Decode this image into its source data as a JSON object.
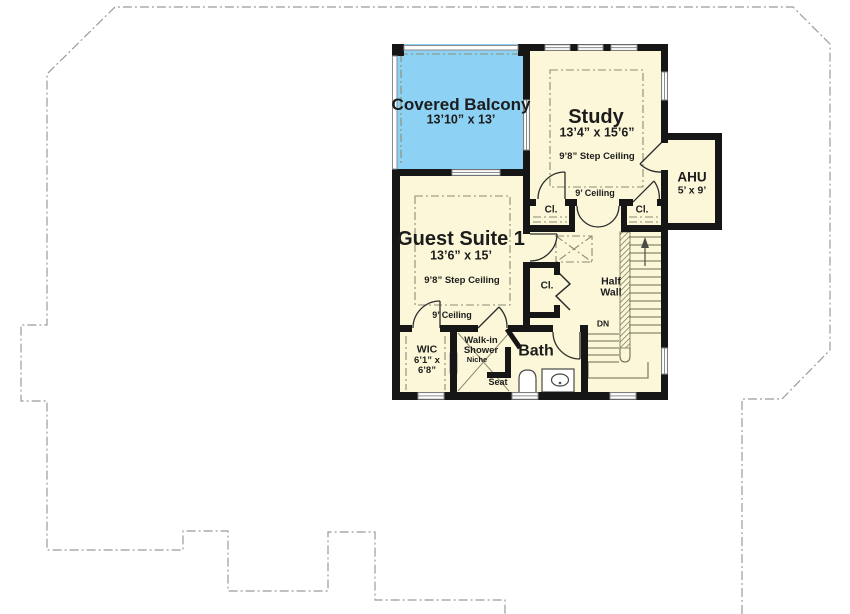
{
  "rooms": {
    "covered_balcony": {
      "name": "Covered Balcony",
      "dims": "13’10” x 13’"
    },
    "study": {
      "name": "Study",
      "dims": "13’4” x 15’6”",
      "step_ceiling": "9’8” Step Ceiling",
      "ceiling": "9’ Ceiling"
    },
    "ahu": {
      "name": "AHU",
      "dims": "5’ x 9’"
    },
    "guest_suite": {
      "name": "Guest Suite 1",
      "dims": "13’6” x 15’",
      "step_ceiling": "9’8” Step Ceiling",
      "ceiling": "9’ Ceiling"
    },
    "wic": {
      "name": "WIC",
      "dims": "6’1” x\n6’8”"
    },
    "bath": {
      "name": "Bath"
    },
    "shower": {
      "name": "Walk-in\nShower",
      "niche": "Niche",
      "seat": "Seat"
    },
    "closets": {
      "upper_left": "Cl.",
      "upper_right": "Cl.",
      "hall": "Cl."
    },
    "stairs": {
      "half_wall": "Half\nWall",
      "down": "DN"
    }
  },
  "colors": {
    "floor": "#FBF7D8",
    "balcony": "#8DD2F4",
    "wall": "#161616",
    "window": "#8a8a8a",
    "ceiling_line": "#8d8d74",
    "stair_line": "#6e6e52",
    "outline": "#9b9b9b",
    "text": "#1c1c1c"
  }
}
